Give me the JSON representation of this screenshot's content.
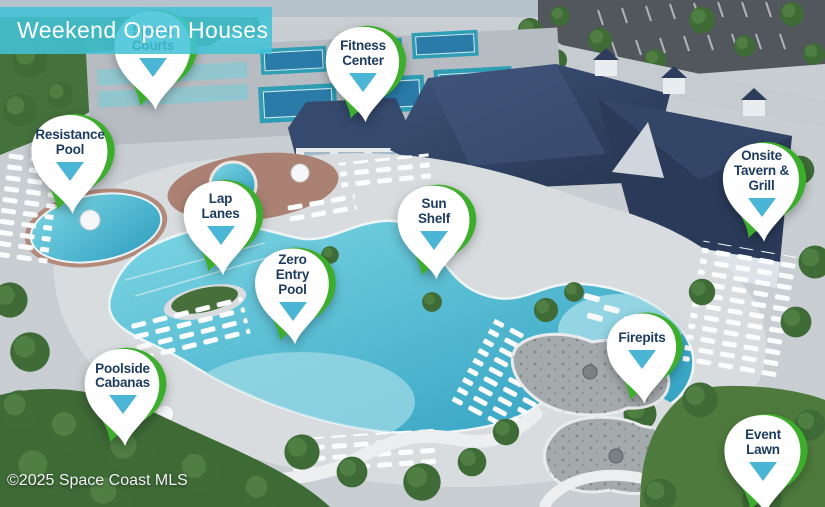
{
  "banner": {
    "title": "Weekend Open Houses"
  },
  "watermark": {
    "text": "©2025 Space Coast MLS"
  },
  "colors": {
    "banner_teal": "#42c2d7",
    "pin_green": "#3dae2c",
    "pointer_teal": "#4ab5d5",
    "label_navy": "#1d3b5e",
    "pool_water": "#3fb0cb"
  },
  "pins": [
    {
      "id": "sports-courts",
      "lines": [
        "Sports",
        "Courts"
      ],
      "x": 103,
      "y": 6,
      "w": 100,
      "h": 112,
      "layer": "under-banner"
    },
    {
      "id": "fitness-center",
      "lines": [
        "Fitness",
        "Center"
      ],
      "x": 314,
      "y": 22,
      "w": 98,
      "h": 108
    },
    {
      "id": "resistance-pool",
      "lines": [
        "Resistance",
        "Pool"
      ],
      "x": 18,
      "y": 110,
      "w": 104,
      "h": 112
    },
    {
      "id": "lap-lanes",
      "lines": [
        "Lap",
        "Lanes"
      ],
      "x": 172,
      "y": 176,
      "w": 97,
      "h": 107
    },
    {
      "id": "zero-entry-pool",
      "lines": [
        "Zero",
        "Entry",
        "Pool"
      ],
      "x": 244,
      "y": 243,
      "w": 97,
      "h": 110
    },
    {
      "id": "sun-shelf",
      "lines": [
        "Sun",
        "Shelf"
      ],
      "x": 386,
      "y": 181,
      "w": 96,
      "h": 106
    },
    {
      "id": "onsite-tavern-grill",
      "lines": [
        "Onsite",
        "Tavern &",
        "Grill"
      ],
      "x": 711,
      "y": 138,
      "w": 101,
      "h": 112
    },
    {
      "id": "firepits",
      "lines": [
        "Firepits"
      ],
      "x": 593,
      "y": 309,
      "w": 98,
      "h": 102
    },
    {
      "id": "poolside-cabanas",
      "lines": [
        "Poolside",
        "Cabanas"
      ],
      "x": 72,
      "y": 344,
      "w": 101,
      "h": 110
    },
    {
      "id": "event-lawn",
      "lines": [
        "Event",
        "Lawn"
      ],
      "x": 712,
      "y": 410,
      "w": 102,
      "h": 112
    }
  ]
}
